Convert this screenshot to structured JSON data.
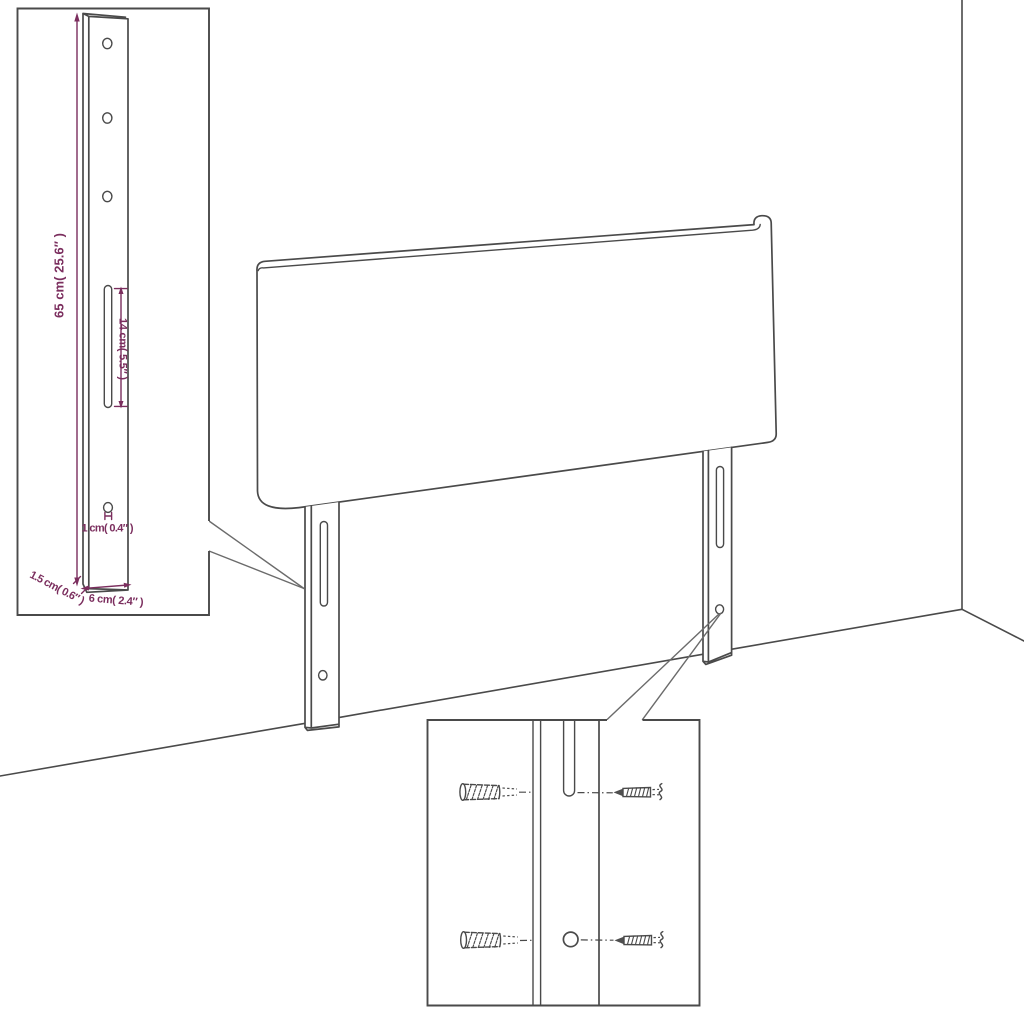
{
  "colors": {
    "line": "#4a4a4a",
    "dimension": "#7b2e5e",
    "background": "#ffffff"
  },
  "bracket_inset": {
    "labels": {
      "height": "65 cm( 25.6″ )",
      "slot_length": "14 cm( 5.5″ )",
      "hole": "1 cm( 0.4″ )",
      "thickness": "1.5 cm( 0.6″ )",
      "width": "6 cm( 2.4″ )"
    }
  }
}
